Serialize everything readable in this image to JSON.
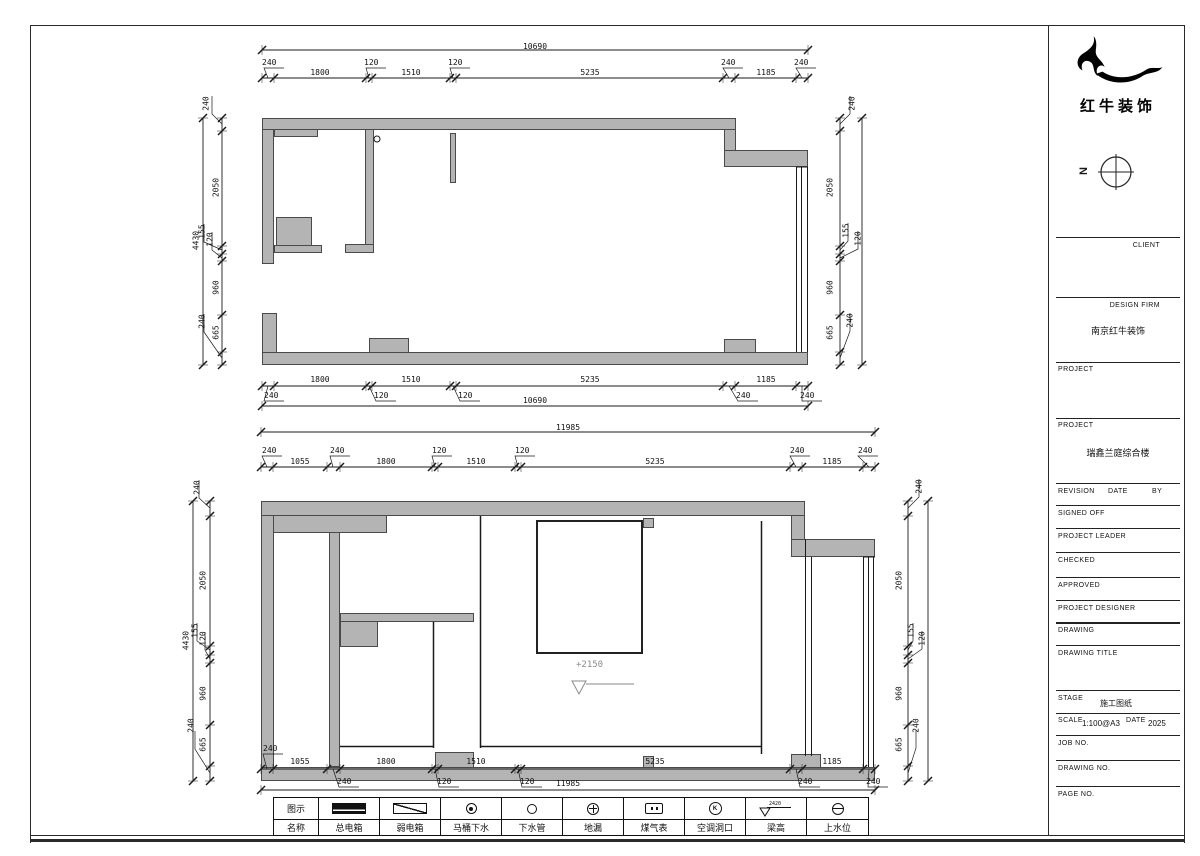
{
  "title_block": {
    "logo_text": "红牛装饰",
    "north_label": "N",
    "client_label": "CLIENT",
    "design_firm_label": "DESIGN  FIRM",
    "design_firm_value": "南京红牛装饰",
    "project1_label": "PROJECT",
    "project2_label": "PROJECT",
    "project2_value": "瑞鑫兰庭综合楼",
    "revision_label": "REVISION",
    "date_label": "DATE",
    "by_label": "BY",
    "signed_off_label": "SIGNED  OFF",
    "project_leader_label": "PROJECT  LEADER",
    "checked_label": "CHECKED",
    "approved_label": "APPROVED",
    "project_designer_label": "PROJECT  DESIGNER",
    "drawing_label": "DRAWING",
    "drawing_title_label": "DRAWING  TITLE",
    "stage_label": "STAGE",
    "stage_value": "施工图纸",
    "scale_label": "SCALE",
    "scale_value": "1:100@A3",
    "date2_label": "DATE",
    "date2_value": "2025",
    "job_no_label": "JOB  NO.",
    "drawing_no_label": "DRAWING  NO.",
    "page_no_label": "PAGE  NO."
  },
  "plans": {
    "level_annotation": "+2150"
  },
  "dims": {
    "p1_top": {
      "overall": "10690",
      "segments": [
        "1800",
        "1510",
        "5235",
        "1185"
      ],
      "leaders": [
        "240",
        "120",
        "120",
        "240",
        "240"
      ]
    },
    "p1_bottom": {
      "overall": "10690",
      "segments": [
        "1800",
        "1510",
        "5235",
        "1185"
      ],
      "leaders": [
        "240",
        "120",
        "120",
        "240",
        "240"
      ]
    },
    "p1_left": {
      "overall": "4430",
      "labels": [
        "240",
        "2050",
        "155",
        "120",
        "960",
        "665",
        "240"
      ]
    },
    "p1_right": {
      "labels": [
        "240",
        "2050",
        "155",
        "120",
        "960",
        "665",
        "240"
      ]
    },
    "p2_top": {
      "overall": "11985",
      "segments": [
        "1055",
        "1800",
        "1510",
        "5235",
        "1185"
      ],
      "leaders": [
        "240",
        "240",
        "120",
        "120",
        "240",
        "240"
      ]
    },
    "p2_bottom": {
      "overall": "11985",
      "segments": [
        "1055",
        "1800",
        "1510",
        "5235",
        "1185"
      ],
      "leaders": [
        "240",
        "240",
        "120",
        "120",
        "240",
        "240"
      ]
    },
    "p2_left": {
      "overall": "4430",
      "labels": [
        "240",
        "2050",
        "155",
        "120",
        "960",
        "665",
        "240"
      ]
    },
    "p2_right": {
      "labels": [
        "240",
        "2050",
        "155",
        "120",
        "960",
        "665",
        "240"
      ]
    }
  },
  "legend": {
    "header_symbol": "图示",
    "header_name": "名称",
    "items": [
      {
        "name": "总电箱"
      },
      {
        "name": "弱电箱"
      },
      {
        "name": "马桶下水"
      },
      {
        "name": "下水管"
      },
      {
        "name": "地漏"
      },
      {
        "name": "煤气表"
      },
      {
        "name": "空调洞口",
        "symbol_text": "K"
      },
      {
        "name": "梁高",
        "symbol_text": "2420"
      },
      {
        "name": "上水位"
      }
    ]
  },
  "colors": {
    "wall_fill": "#b4b4b4",
    "line": "#1a1a1a",
    "annotation_gray": "#8a8a8a"
  }
}
